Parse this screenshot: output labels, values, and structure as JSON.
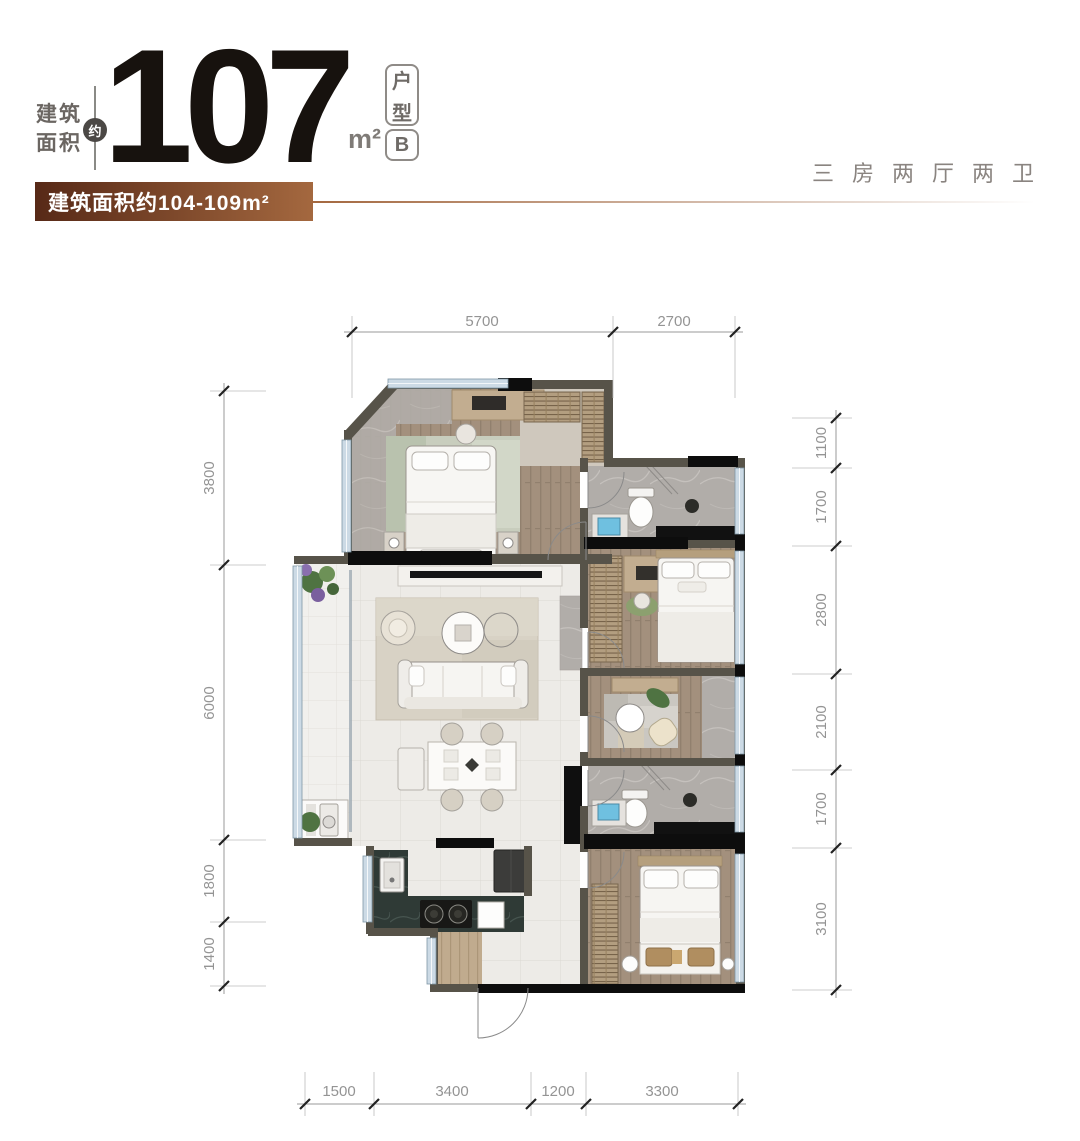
{
  "header": {
    "area_label": {
      "line1": "建筑",
      "line2": "面积"
    },
    "approx_badge": "约",
    "area_value": "107",
    "area_unit": "m²",
    "unit_type": [
      "户",
      "型",
      "B"
    ],
    "banner": "建筑面积约104-109m²",
    "layout_summary": "三房两厅两卫"
  },
  "plan": {
    "dimensions": {
      "top": [
        "5700",
        "2700"
      ],
      "left": [
        "3800",
        "6000",
        "1800",
        "1400"
      ],
      "right": [
        "1100",
        "1700",
        "2800",
        "2100",
        "1700",
        "3100"
      ],
      "bottom": [
        "1500",
        "3400",
        "1200",
        "3300"
      ]
    }
  },
  "colors": {
    "banner_gradient_start": "#572917",
    "banner_gradient_end": "#a4683f",
    "accent_line": "#a4683f",
    "headline_text": "#17120e",
    "muted_text": "#8a8480",
    "dimension_text": "#949494",
    "wall": "#575349",
    "wall_accent": "#0d0d0d",
    "window_glass": "#ccdae5",
    "wood_floor": "#a3907d",
    "tile_floor": "#edebe7",
    "marble_floor": "#b1ada9",
    "counter_dark": "#2f3a36",
    "sink_blue": "#6fc0e0",
    "plant_green": "#4f7342"
  }
}
